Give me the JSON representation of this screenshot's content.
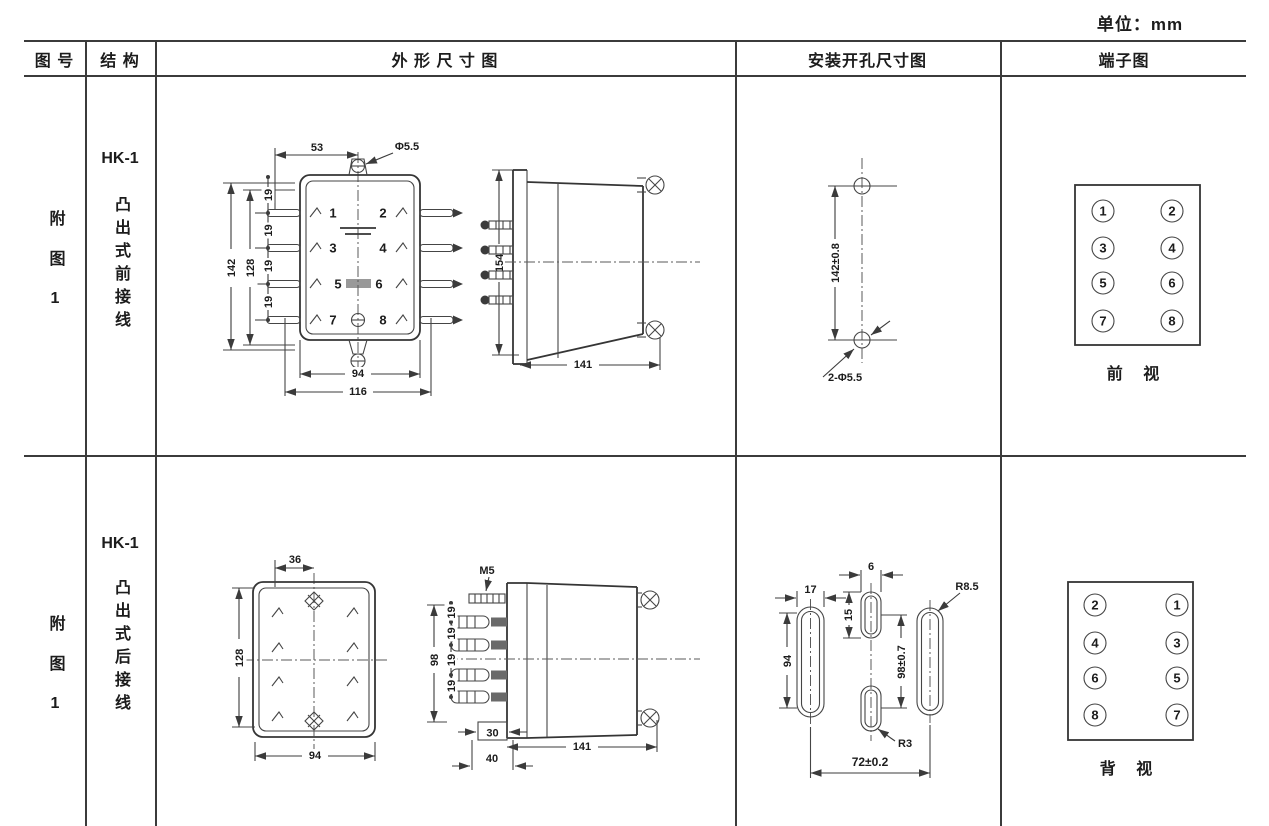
{
  "unit_label": "单位：mm",
  "header": {
    "figure": "图 号",
    "structure": "结 构",
    "outline": "外 形 尺 寸 图",
    "mounting": "安装开孔尺寸图",
    "terminal": "端子图"
  },
  "rows": [
    {
      "figure_no": "附图1",
      "model": "HK-1",
      "structure": "凸出式前接线",
      "outline": {
        "terminals": [
          "1",
          "2",
          "3",
          "4",
          "5",
          "6",
          "7",
          "8"
        ],
        "dims": {
          "top_width": "53",
          "hole": "Φ5.5",
          "outer_height": "142",
          "body_height": "128",
          "pitch": "19",
          "bottom_inner": "94",
          "bottom_outer": "116",
          "side_height": "154",
          "depth": "141"
        }
      },
      "mounting": {
        "dims": {
          "hole_pitch": "142±0.8",
          "holes": "2-Φ5.5"
        }
      },
      "terminal": {
        "pairs": [
          [
            "1",
            "2"
          ],
          [
            "3",
            "4"
          ],
          [
            "5",
            "6"
          ],
          [
            "7",
            "8"
          ]
        ],
        "view_label": "前 视"
      }
    },
    {
      "figure_no": "附图1",
      "model": "HK-1",
      "structure": "凸出式后接线",
      "outline": {
        "dims": {
          "top_width": "36",
          "body_height": "128",
          "bottom_width": "94",
          "stud": "M5",
          "stud_span": "98",
          "pitch": "19",
          "block": "30",
          "block_outer": "40",
          "depth": "141"
        }
      },
      "mounting": {
        "dims": {
          "slot_width": "17",
          "slot_height": "94",
          "center_slot_width": "6",
          "center_slot_height": "15",
          "radius_outer": "R8.5",
          "center_pitch": "98±0.7",
          "radius_center": "R3",
          "slot_pitch": "72±0.2"
        }
      },
      "terminal": {
        "pairs": [
          [
            "2",
            "1"
          ],
          [
            "4",
            "3"
          ],
          [
            "6",
            "5"
          ],
          [
            "8",
            "7"
          ]
        ],
        "view_label": "背 视"
      }
    }
  ]
}
